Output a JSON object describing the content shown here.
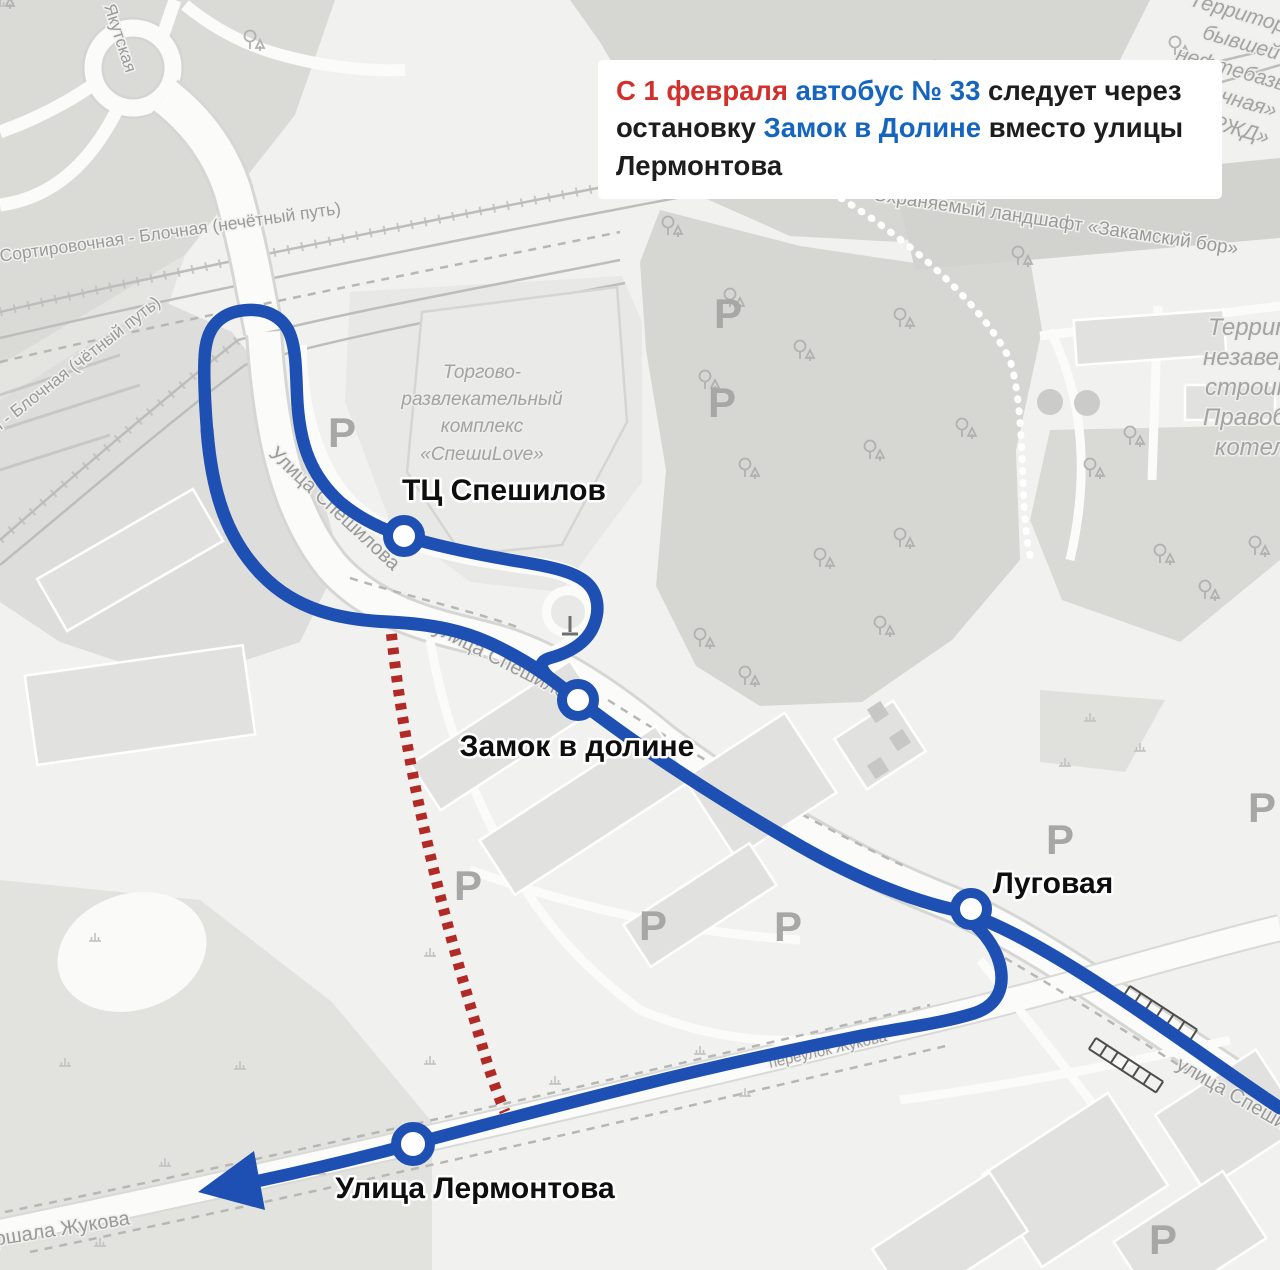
{
  "announcement": {
    "l1s1": "С 1 февраля ",
    "l1s2": "автобус № 33",
    "l1s3": " следует через",
    "l2s1": "остановку ",
    "l2s2": "Замок в Долине",
    "l2s3": " вместо улицы",
    "l3s1": "Лермонтова",
    "colors": {
      "highlight_red": "#d2302c",
      "highlight_blue": "#1565c0",
      "text": "#1d1d1d",
      "background": "#ffffff"
    }
  },
  "route": {
    "bus_number": "33",
    "line_color": "#1e4fb2",
    "former_segment_color": "#b22a26"
  },
  "stops": [
    {
      "name": "ТЦ Спешилов"
    },
    {
      "name": "Замок в долине"
    },
    {
      "name": "Луговая"
    },
    {
      "name": "Улица Лермонтова"
    }
  ],
  "map_labels": {
    "street_speshilova_upper": "Улица Спешилова",
    "street_speshilova_mid": "улица Спешилова",
    "street_speshilova_lower": "улица Спешилова",
    "railway_odd": "Пермь-Сортировочная - Блочная (нечётный путь)",
    "railway_even": "Сортировочная - Блочная (чётный путь)",
    "street_zhukova": "Маршала Жукова",
    "street_pereulok_zhukova": "переулок Жукова",
    "street_yakutskaya": "Якутская",
    "mall_line1": "Торгово-",
    "mall_line2": "развлекательный",
    "mall_line3": "комплекс",
    "mall_line4": "«СпешиLove»",
    "zakamsky_band": "Охраняемый ландшафт «Закамский бор»",
    "territory_top_line1": "Территория",
    "territory_top_line2": "бывшей",
    "territory_top_line3": "нефтебазы",
    "territory_top_line4": "«Блочная»",
    "territory_top_line5": "АО «РЖД»",
    "territory_right_line1": "Территория",
    "territory_right_line2": "незавершенного",
    "territory_right_line3": "строительства",
    "territory_right_line4": "Правобережной",
    "territory_right_line5": "котельной",
    "parking": "Р"
  }
}
